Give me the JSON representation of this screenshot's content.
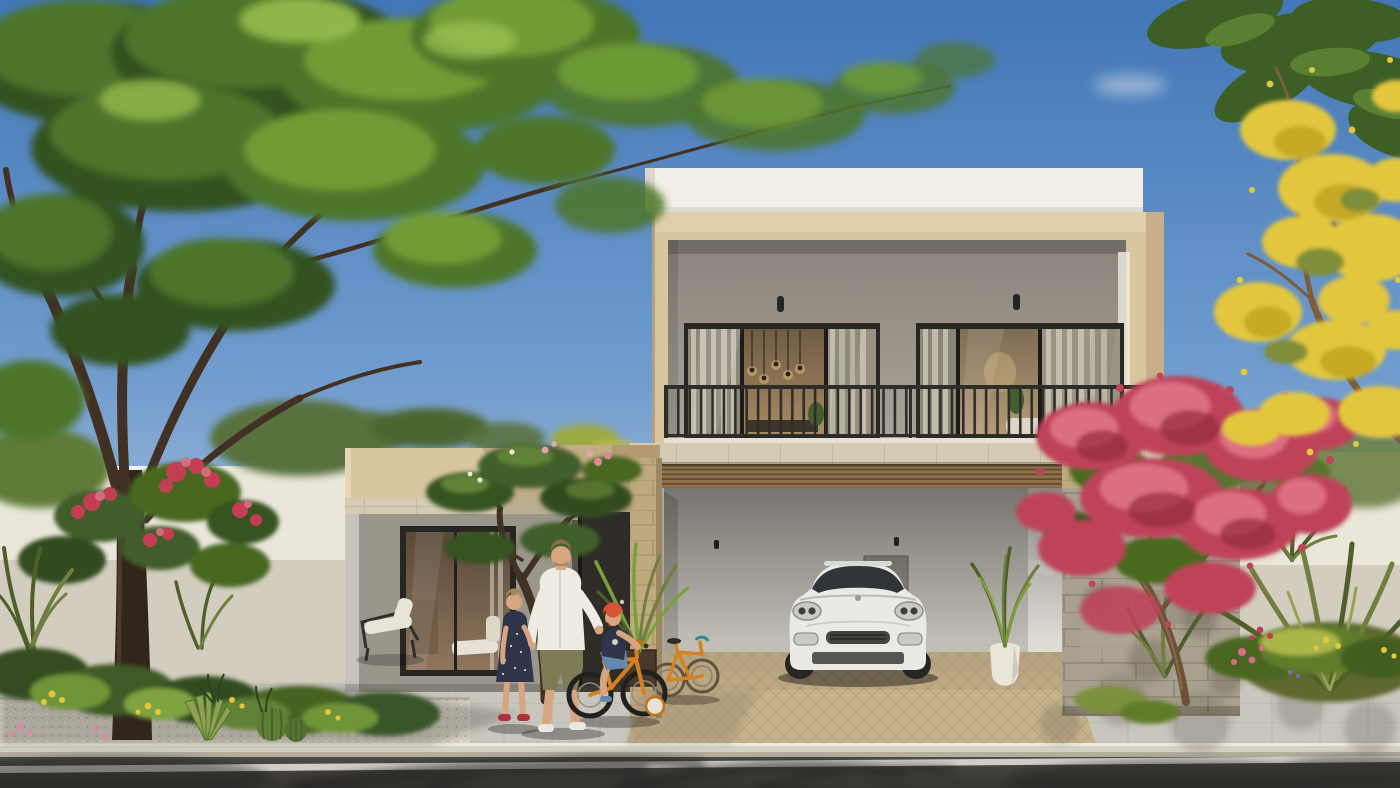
{
  "scene": {
    "type": "photorealistic-architectural-rendering",
    "description": "Street view of a modern two-storey sand-and-white villa with recessed balcony, double carport with white SUV, stone-clad walls, desert landscaping, a father walking with a girl while a boy rides an orange bicycle with training wheels on the sidewalk",
    "time_of_day": "sunny daytime, clear blue sky",
    "people_count": 3,
    "people": [
      "father in white shirt and olive shorts",
      "girl in navy polka-dot dress",
      "boy in red helmet on orange bicycle"
    ],
    "vehicles": [
      "white SUV parked in carport",
      "orange bicycle leaning on carport wall",
      "orange child bicycle with training wheels"
    ],
    "building": {
      "storeys": 2,
      "upper_floor": "recessed balcony with two black-framed sliding glass doors and black metal railing",
      "ground_floor": "open double carport with timber-slat soffit, entrance door, single-storey wing with large window",
      "materials": [
        "white parapet",
        "sand-beige render",
        "travertine band",
        "sand stone pillar",
        "grey stone cladding",
        "timber slats"
      ]
    },
    "vegetation": [
      "large green tree on left",
      "red flowering shrubs",
      "plumeria tree",
      "potted palms",
      "pink bougainvillea on right",
      "fan palms",
      "yellow flowering tree top right",
      "barrel cactus and agave in gravel bed"
    ],
    "street": [
      "grey paver sidewalk",
      "beige paver driveway",
      "gravel planting strip",
      "concrete curb",
      "dark asphalt road with white line",
      "tree shadows across road"
    ]
  },
  "palette": {
    "skyTop": "#3f74b6",
    "skyMid": "#6f9bce",
    "skyLow": "#a9c4de",
    "skyHorizon": "#e4e8e4",
    "cloud": "#f1f3ef",
    "parapetWhite": "#f1efe7",
    "beige": "#d8c5a0",
    "beigeShadow": "#c1a982",
    "grayWall": "#9a948a",
    "frameBlack": "#23221f",
    "railing": "#2b2925",
    "travertine": "#d5cab1",
    "stonePillar": "#bea87d",
    "stoneGray": "#a89f8e",
    "carportBack": "#c9c5bd",
    "carportLeft": "#a9a59d",
    "carportRight": "#e9e6df",
    "woodSoffit": "#8d6f49",
    "driveway": "#c5b189",
    "sidewalk": "#c8c5bd",
    "gravel": "#d7d1c3",
    "curb": "#d6d1c4",
    "asphalt": "#413f3b",
    "roadLine": "#e9e6de",
    "doorDark": "#2b2824",
    "bgWall": "#eae6da",
    "bgWallShade": "#d2ccbe",
    "carBody": "#e9e9e6",
    "carGlass": "#2e3134",
    "trunk": "#3e2d20",
    "trunkLight": "#7a6047",
    "foliageDark": "#2f4f1d",
    "foliageMid": "#4a7327",
    "foliageLight": "#6f9c33",
    "foliageHi": "#9ec54f",
    "flowerRed": "#c23a50",
    "flowerPink": "#dd6d80",
    "flowerYellow": "#e2c63a",
    "palmDark": "#4c5c26",
    "palmMid": "#6f7c3c",
    "palmLight": "#76a038",
    "bougainvillea": "#bd4156",
    "skin": "#d7a47e",
    "shirtWhite": "#eeebe2",
    "shortsOlive": "#7b7a52",
    "dressNavy": "#2b3046",
    "helmetRed": "#d8512e",
    "teeNavy": "#2a3148",
    "denim": "#6286ad",
    "bikeOrange": "#d2801f",
    "chairFrame": "#2e2b27",
    "vaseWhite": "#e9e5d8",
    "shoeRed": "#a8303c"
  }
}
